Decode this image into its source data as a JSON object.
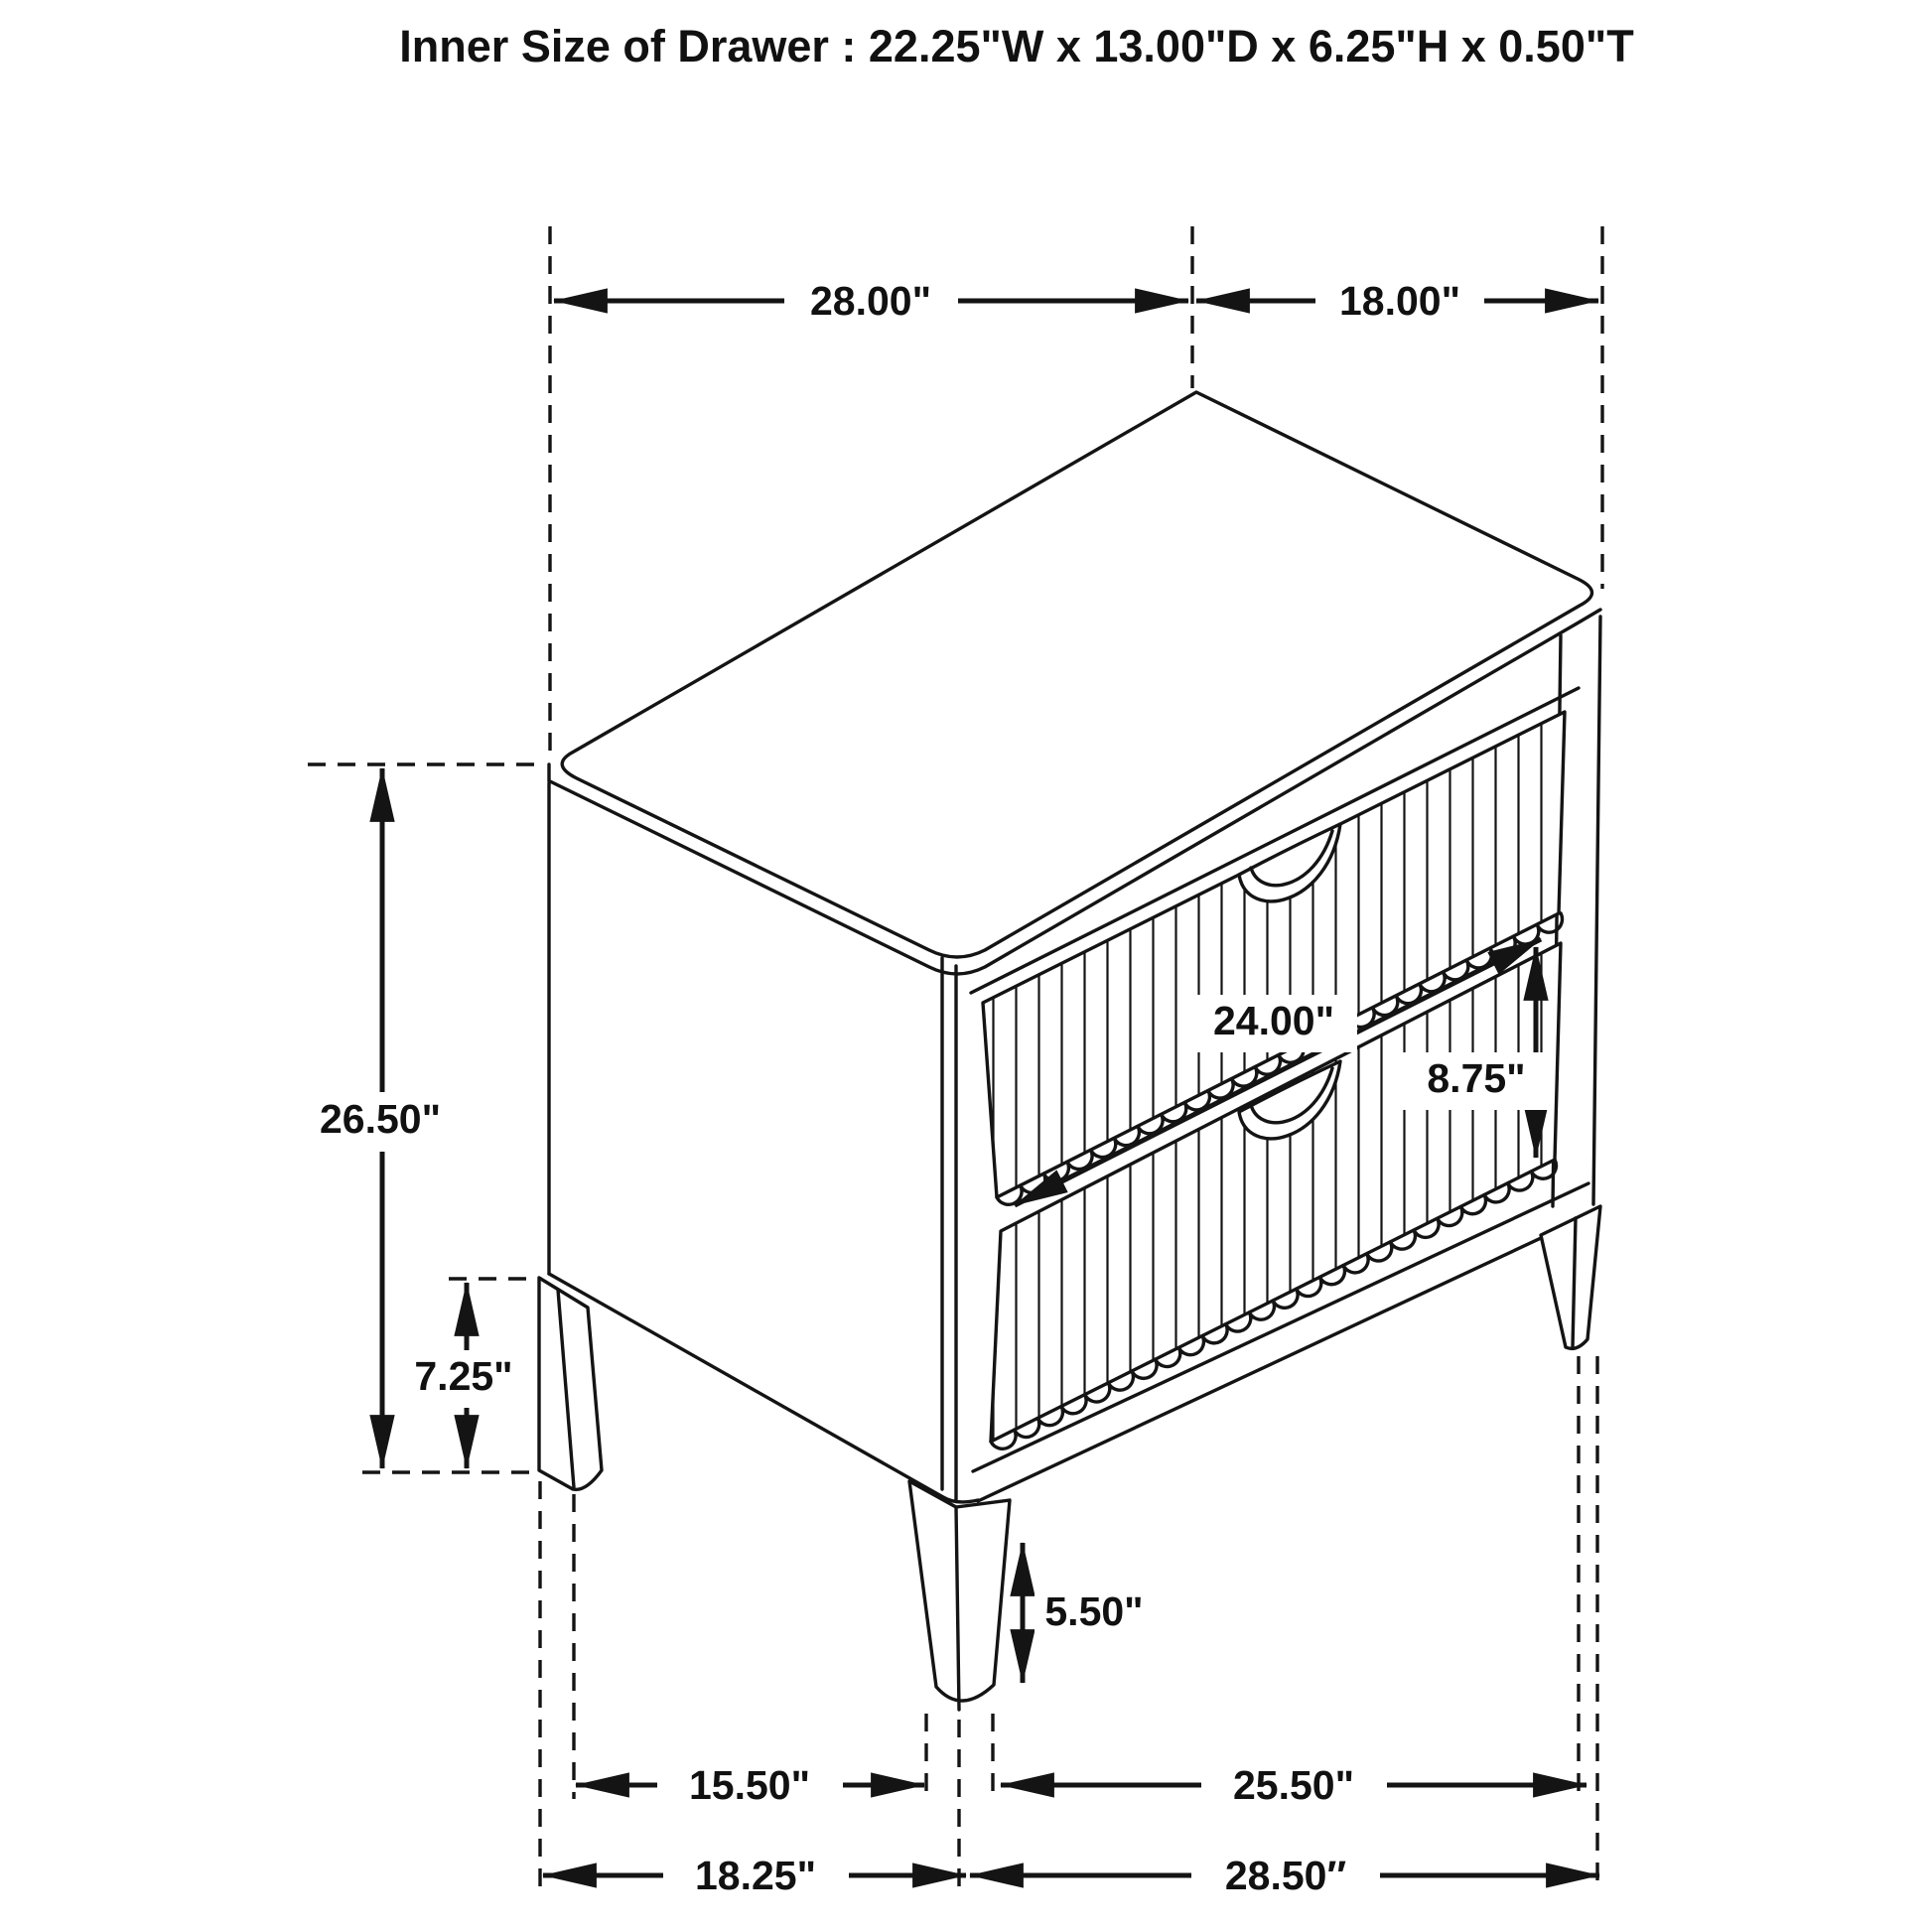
{
  "title": "Inner Size of Drawer : 22.25\"W x 13.00\"D x 6.25\"H x 0.50\"T",
  "colors": {
    "line": "#141414",
    "background": "#ffffff",
    "text": "#111111"
  },
  "dims": {
    "top_width": {
      "label": "28.00\""
    },
    "top_depth": {
      "label": "18.00\""
    },
    "overall_height": {
      "label": "26.50\""
    },
    "left_leg_height": {
      "label": "7.25\""
    },
    "drawer_width": {
      "label": "24.00\""
    },
    "drawer_front_height": {
      "label": "8.75\""
    },
    "front_leg_height": {
      "label": "5.50\""
    },
    "inner_span_left": {
      "label": "15.50\""
    },
    "inner_span_right": {
      "label": "25.50\""
    },
    "outer_span_left": {
      "label": "18.25\""
    },
    "outer_span_right": {
      "label": "28.50″"
    }
  }
}
